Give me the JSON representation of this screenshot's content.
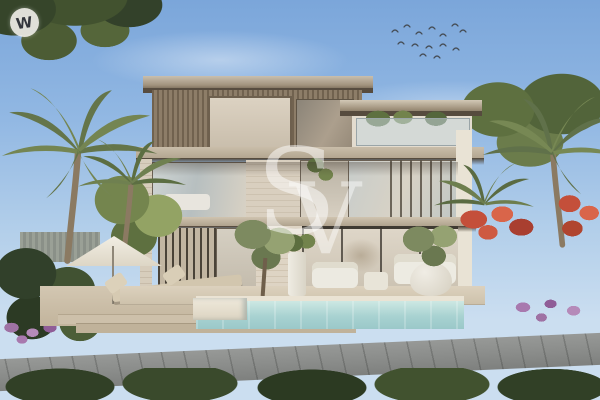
{
  "image": {
    "kind": "architectural exterior rendering",
    "subject": "Modern three-storey villa with lap pool, sun deck and tropical garden",
    "time_of_day": "daytime, clear sky"
  },
  "watermarks": {
    "corner_badge_letter": "W",
    "center_monogram_first": "S",
    "center_monogram_second": "V"
  },
  "palette": {
    "sky_top": "#7BA6DA",
    "sky_horizon": "#CBDEF0",
    "foliage_dark": "#35442A",
    "foliage_mid": "#5C6E3F",
    "foliage_light": "#8C9C63",
    "palm_frond": "#64754A",
    "palm_trunk": "#8B7A62",
    "cladding_bronze": "#8A7963",
    "cladding_bronze_dark": "#6E5F4D",
    "roof_fascia": "#C8BCA9",
    "slab_underside": "#4C4237",
    "stone_travertine": "#D9CFBF",
    "glass_cool": "#C6D0D2",
    "glass_warm": "#D7CEC0",
    "white_trim": "#E9E3D5",
    "terrace": "#D8CDBA",
    "timber_deck": "#CBBEA7",
    "pool_water": "#A6D0CF",
    "pool_highlight": "#CDE8E3",
    "pool_coping": "#EAE3D4",
    "grass_mid": "#5A6B3C",
    "grass_dark": "#314026",
    "footpath_grey": "#8B8D8B",
    "flower_red": "#C44F3A",
    "flower_purple": "#9F72A4",
    "parasol": "#ECE7DB",
    "birds": "#454C54"
  }
}
